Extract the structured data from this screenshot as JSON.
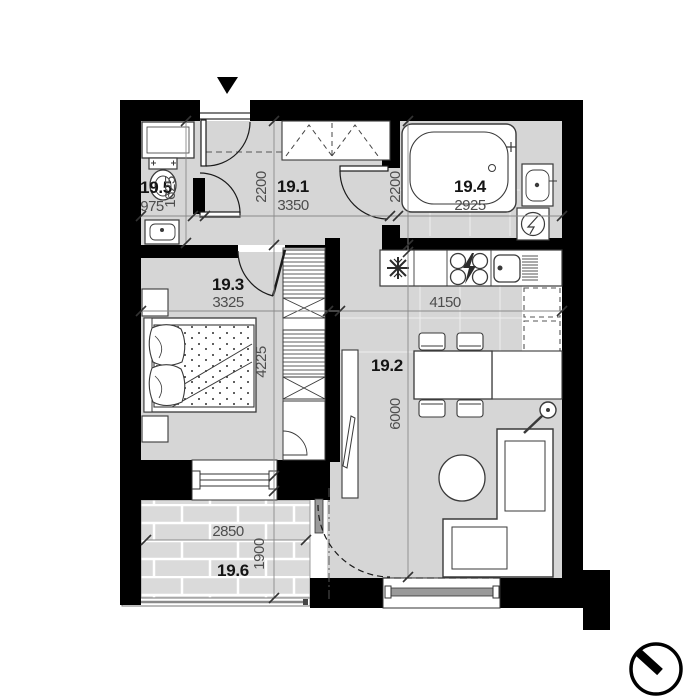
{
  "plan": {
    "type": "apartment-floor-plan",
    "rooms": [
      {
        "id": "19.1",
        "kind": "hallway",
        "width_mm": "3350",
        "depth_mm": "2200"
      },
      {
        "id": "19.2",
        "kind": "living-kitchen",
        "width_mm": "4150",
        "depth_mm": "6000"
      },
      {
        "id": "19.3",
        "kind": "bedroom",
        "width_mm": "3325",
        "depth_mm": "4225"
      },
      {
        "id": "19.4",
        "kind": "bathroom",
        "width_mm": "2925",
        "depth_mm": "2200"
      },
      {
        "id": "19.5",
        "kind": "wc",
        "width_mm": "975",
        "depth_mm": "1625"
      },
      {
        "id": "19.6",
        "kind": "balcony",
        "width_mm": "2850",
        "depth_mm": "1900"
      }
    ],
    "icons": {
      "entrance_arrow": "filled-triangle-down",
      "north_indicator": "circle-with-needle",
      "fridge": "snowflake",
      "stove": "four-burners-lightning",
      "washing_machine": "square-with-drum"
    },
    "colors": {
      "wall": "#000000",
      "floor": "#d6d6d6",
      "balcony_floor": "#dadada",
      "fixture_stroke": "#3a3a3a",
      "dimension": "#4d4d4d"
    }
  }
}
